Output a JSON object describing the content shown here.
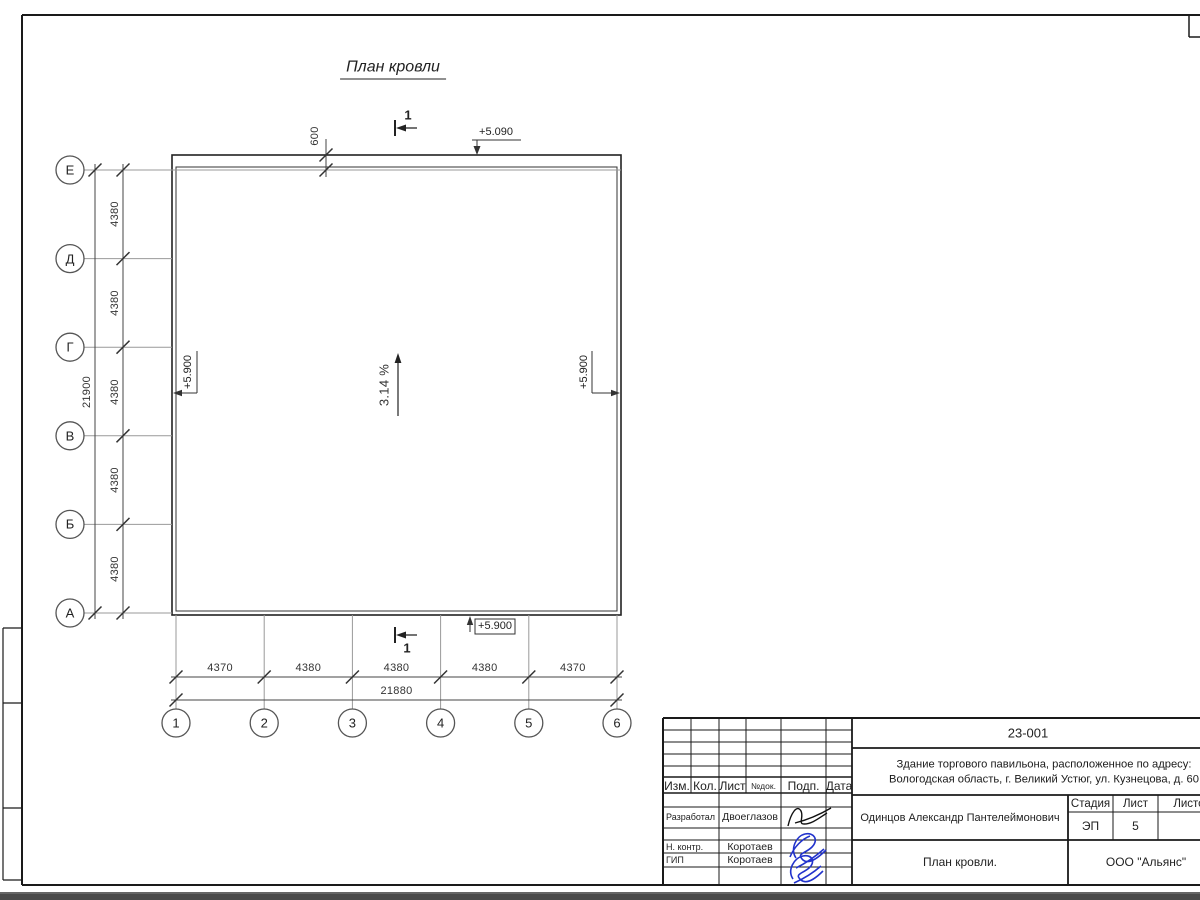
{
  "plan": {
    "title": "План кровли",
    "slope": "3.14 %",
    "section_label": "1",
    "top_offset_dim": "600",
    "elevation_top": "+5.090",
    "elevation_bottom": "+5.900",
    "elevation_left": "+5.900",
    "elevation_right": "+5.900",
    "grid": {
      "rows": [
        "Е",
        "Д",
        "Г",
        "В",
        "Б",
        "А"
      ],
      "cols": [
        "1",
        "2",
        "3",
        "4",
        "5",
        "6"
      ],
      "row_dims": [
        "4380",
        "4380",
        "4380",
        "4380",
        "4380"
      ],
      "row_total": "21900",
      "col_dims": [
        "4370",
        "4380",
        "4380",
        "4380",
        "4370"
      ],
      "col_total": "21880"
    }
  },
  "title_block": {
    "doc_number": "23-001",
    "object_address_line1": "Здание торгового павильона, расположенное по адресу:",
    "object_address_line2": "Вологодская область, г. Великий Устюг, ул. Кузнецова, д. 60",
    "client": "Одинцов Александр Пантелеймонович",
    "drawing_title": "План кровли.",
    "company": "ООО \"Альянс\"",
    "stage": {
      "label": "Стадия",
      "value": "ЭП"
    },
    "sheet": {
      "label": "Лист",
      "value": "5"
    },
    "sheets": {
      "label": "Листов",
      "value": ""
    },
    "header_cols": [
      "Изм.",
      "Кол.",
      "Лист",
      "№док.",
      "Подп.",
      "Дата"
    ],
    "signature_rows": [
      {
        "role": "Разработал",
        "name": "Двоеглазов"
      },
      {
        "role": "Н. контр.",
        "name": "Коротаев"
      },
      {
        "role": "ГИП",
        "name": "Коротаев"
      }
    ]
  },
  "colors": {
    "line": "#1a1a1a",
    "grid_line": "#999999",
    "signature_blue": "#2233cc"
  }
}
